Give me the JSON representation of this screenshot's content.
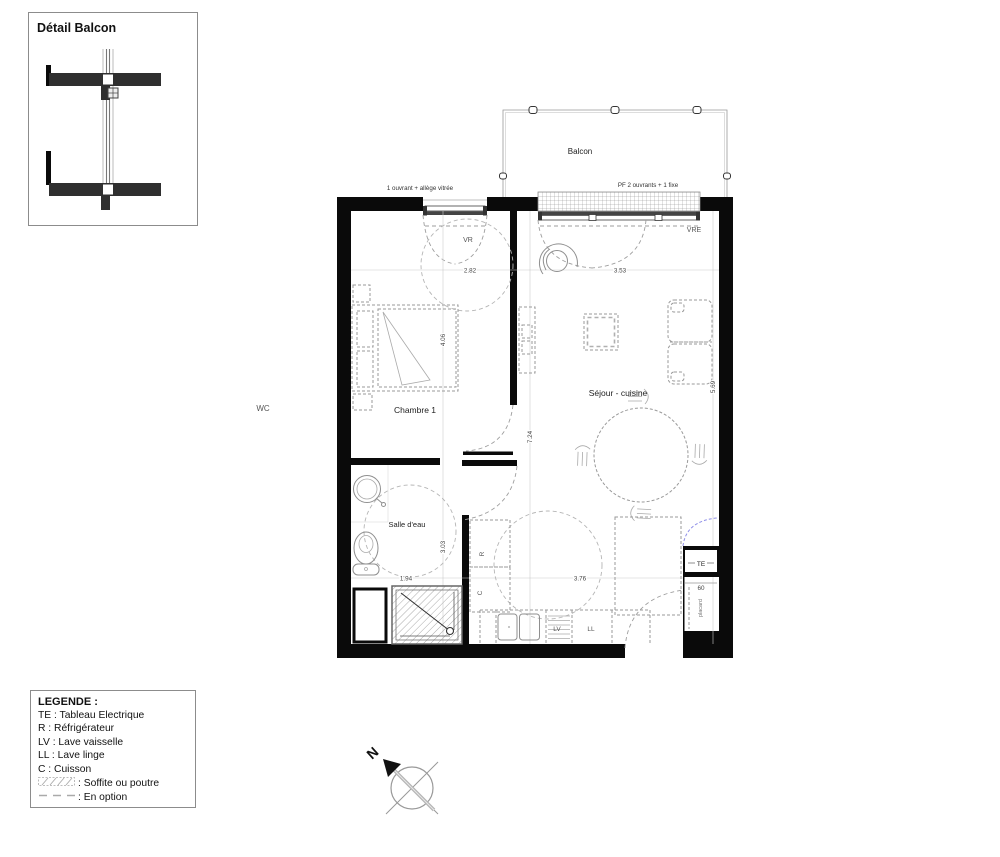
{
  "detail_box": {
    "title": "Détail Balcon"
  },
  "plan": {
    "balcony": {
      "label": "Balcon"
    },
    "windows": {
      "window1_label": "1 ouvrant + allège vitrée",
      "window2_label": "PF 2 ouvrants + 1 fixe",
      "vr_label": "VR",
      "vre_label": "VRE"
    },
    "rooms": {
      "bedroom": "Chambre 1",
      "living": "Séjour - cuisine",
      "bathroom": "Salle d'eau",
      "wc": "WC",
      "closet": "placard"
    },
    "appliances": {
      "te": "TE",
      "fridge": "R",
      "cooktop": "C",
      "dishwasher": "LV",
      "washer": "LL"
    },
    "dimensions": {
      "bedroom_width": "2.82",
      "living_width": "3.53",
      "bedroom_depth": "4.06",
      "overall_depth": "7.24",
      "living_depth": "5.69",
      "bathroom_depth": "3.03",
      "bathroom_width": "1.94",
      "kitchen_width": "3.76",
      "te_width": "60"
    }
  },
  "legend": {
    "title": "LEGENDE :",
    "items": [
      "TE : Tableau Electrique",
      "R : Réfrigérateur",
      "LV : Lave vaisselle",
      "LL : Lave linge",
      "C : Cuisson"
    ],
    "soffite_label": ": Soffite ou poutre",
    "option_label": ": En option"
  },
  "compass": {
    "north": "N"
  },
  "colors": {
    "wall": "#0a0a0a",
    "furniture": "#9a9a9a",
    "dimension_text": "#444444",
    "option_blue": "#8f8fe8"
  }
}
